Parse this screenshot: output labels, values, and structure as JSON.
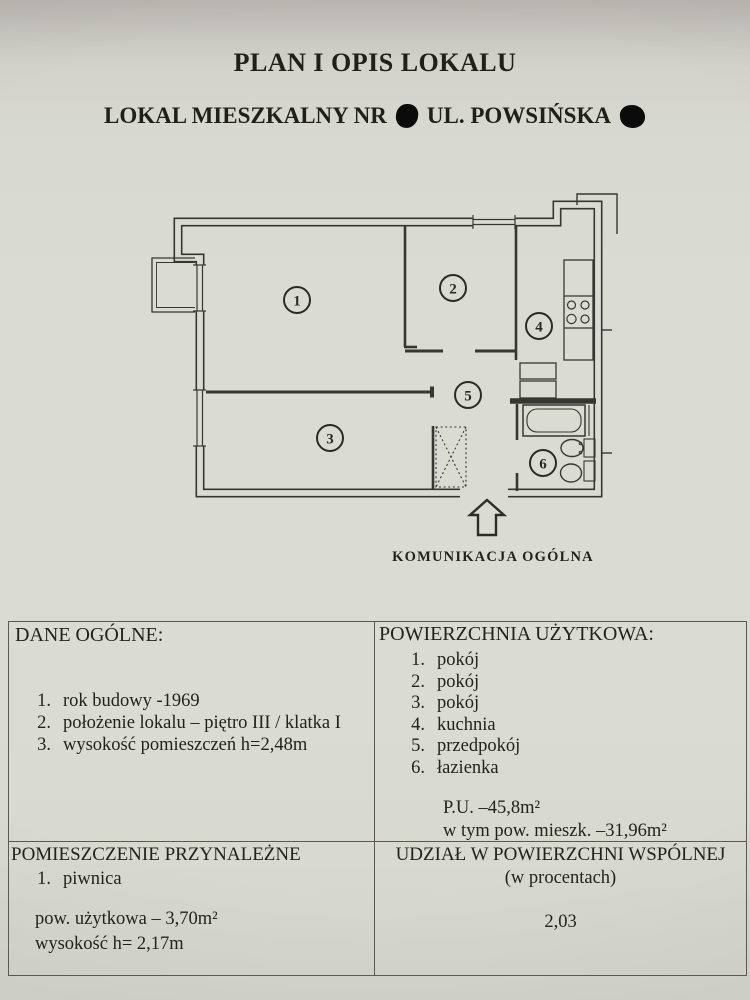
{
  "document": {
    "title": "PLAN I OPIS LOKALU",
    "subtitle_prefix": "LOKAL MIESZKALNY NR",
    "subtitle_street": "UL. POWSIŃSKA",
    "plan_caption": "KOMUNIKACJA OGÓLNA"
  },
  "floor_plan": {
    "room_labels": [
      "1",
      "2",
      "3",
      "4",
      "5",
      "6"
    ]
  },
  "sections": {
    "dane_ogolne": {
      "header": "DANE OGÓLNE:",
      "items": [
        {
          "num": "1.",
          "text": "rok budowy -1969"
        },
        {
          "num": "2.",
          "text": "położenie lokalu – piętro III / klatka I"
        },
        {
          "num": "3.",
          "text": "wysokość pomieszczeń h=2,48m"
        }
      ]
    },
    "powierzchnia_uzytkowa": {
      "header": "POWIERZCHNIA UŻYTKOWA:",
      "items": [
        {
          "num": "1.",
          "text": "pokój"
        },
        {
          "num": "2.",
          "text": "pokój"
        },
        {
          "num": "3.",
          "text": "pokój"
        },
        {
          "num": "4.",
          "text": "kuchnia"
        },
        {
          "num": "5.",
          "text": "przedpokój"
        },
        {
          "num": "6.",
          "text": "łazienka"
        }
      ],
      "total": "P.U. –45,8m²",
      "residential": "w tym pow. mieszk. –31,96m²"
    },
    "pomieszczenie_przynalezne": {
      "header": "POMIESZCZENIE PRZYNALEŻNE",
      "items": [
        {
          "num": "1.",
          "text": "piwnica"
        }
      ],
      "area": "pow. użytkowa – 3,70m²",
      "height": "wysokość h= 2,17m"
    },
    "udzial": {
      "header_line1": "UDZIAŁ W POWIERZCHNI WSPÓLNEJ",
      "header_line2": "(w procentach)",
      "value": "2,03"
    }
  },
  "colors": {
    "paper": "#dadcd4",
    "ink": "#383633",
    "table_border": "#5d594f"
  }
}
